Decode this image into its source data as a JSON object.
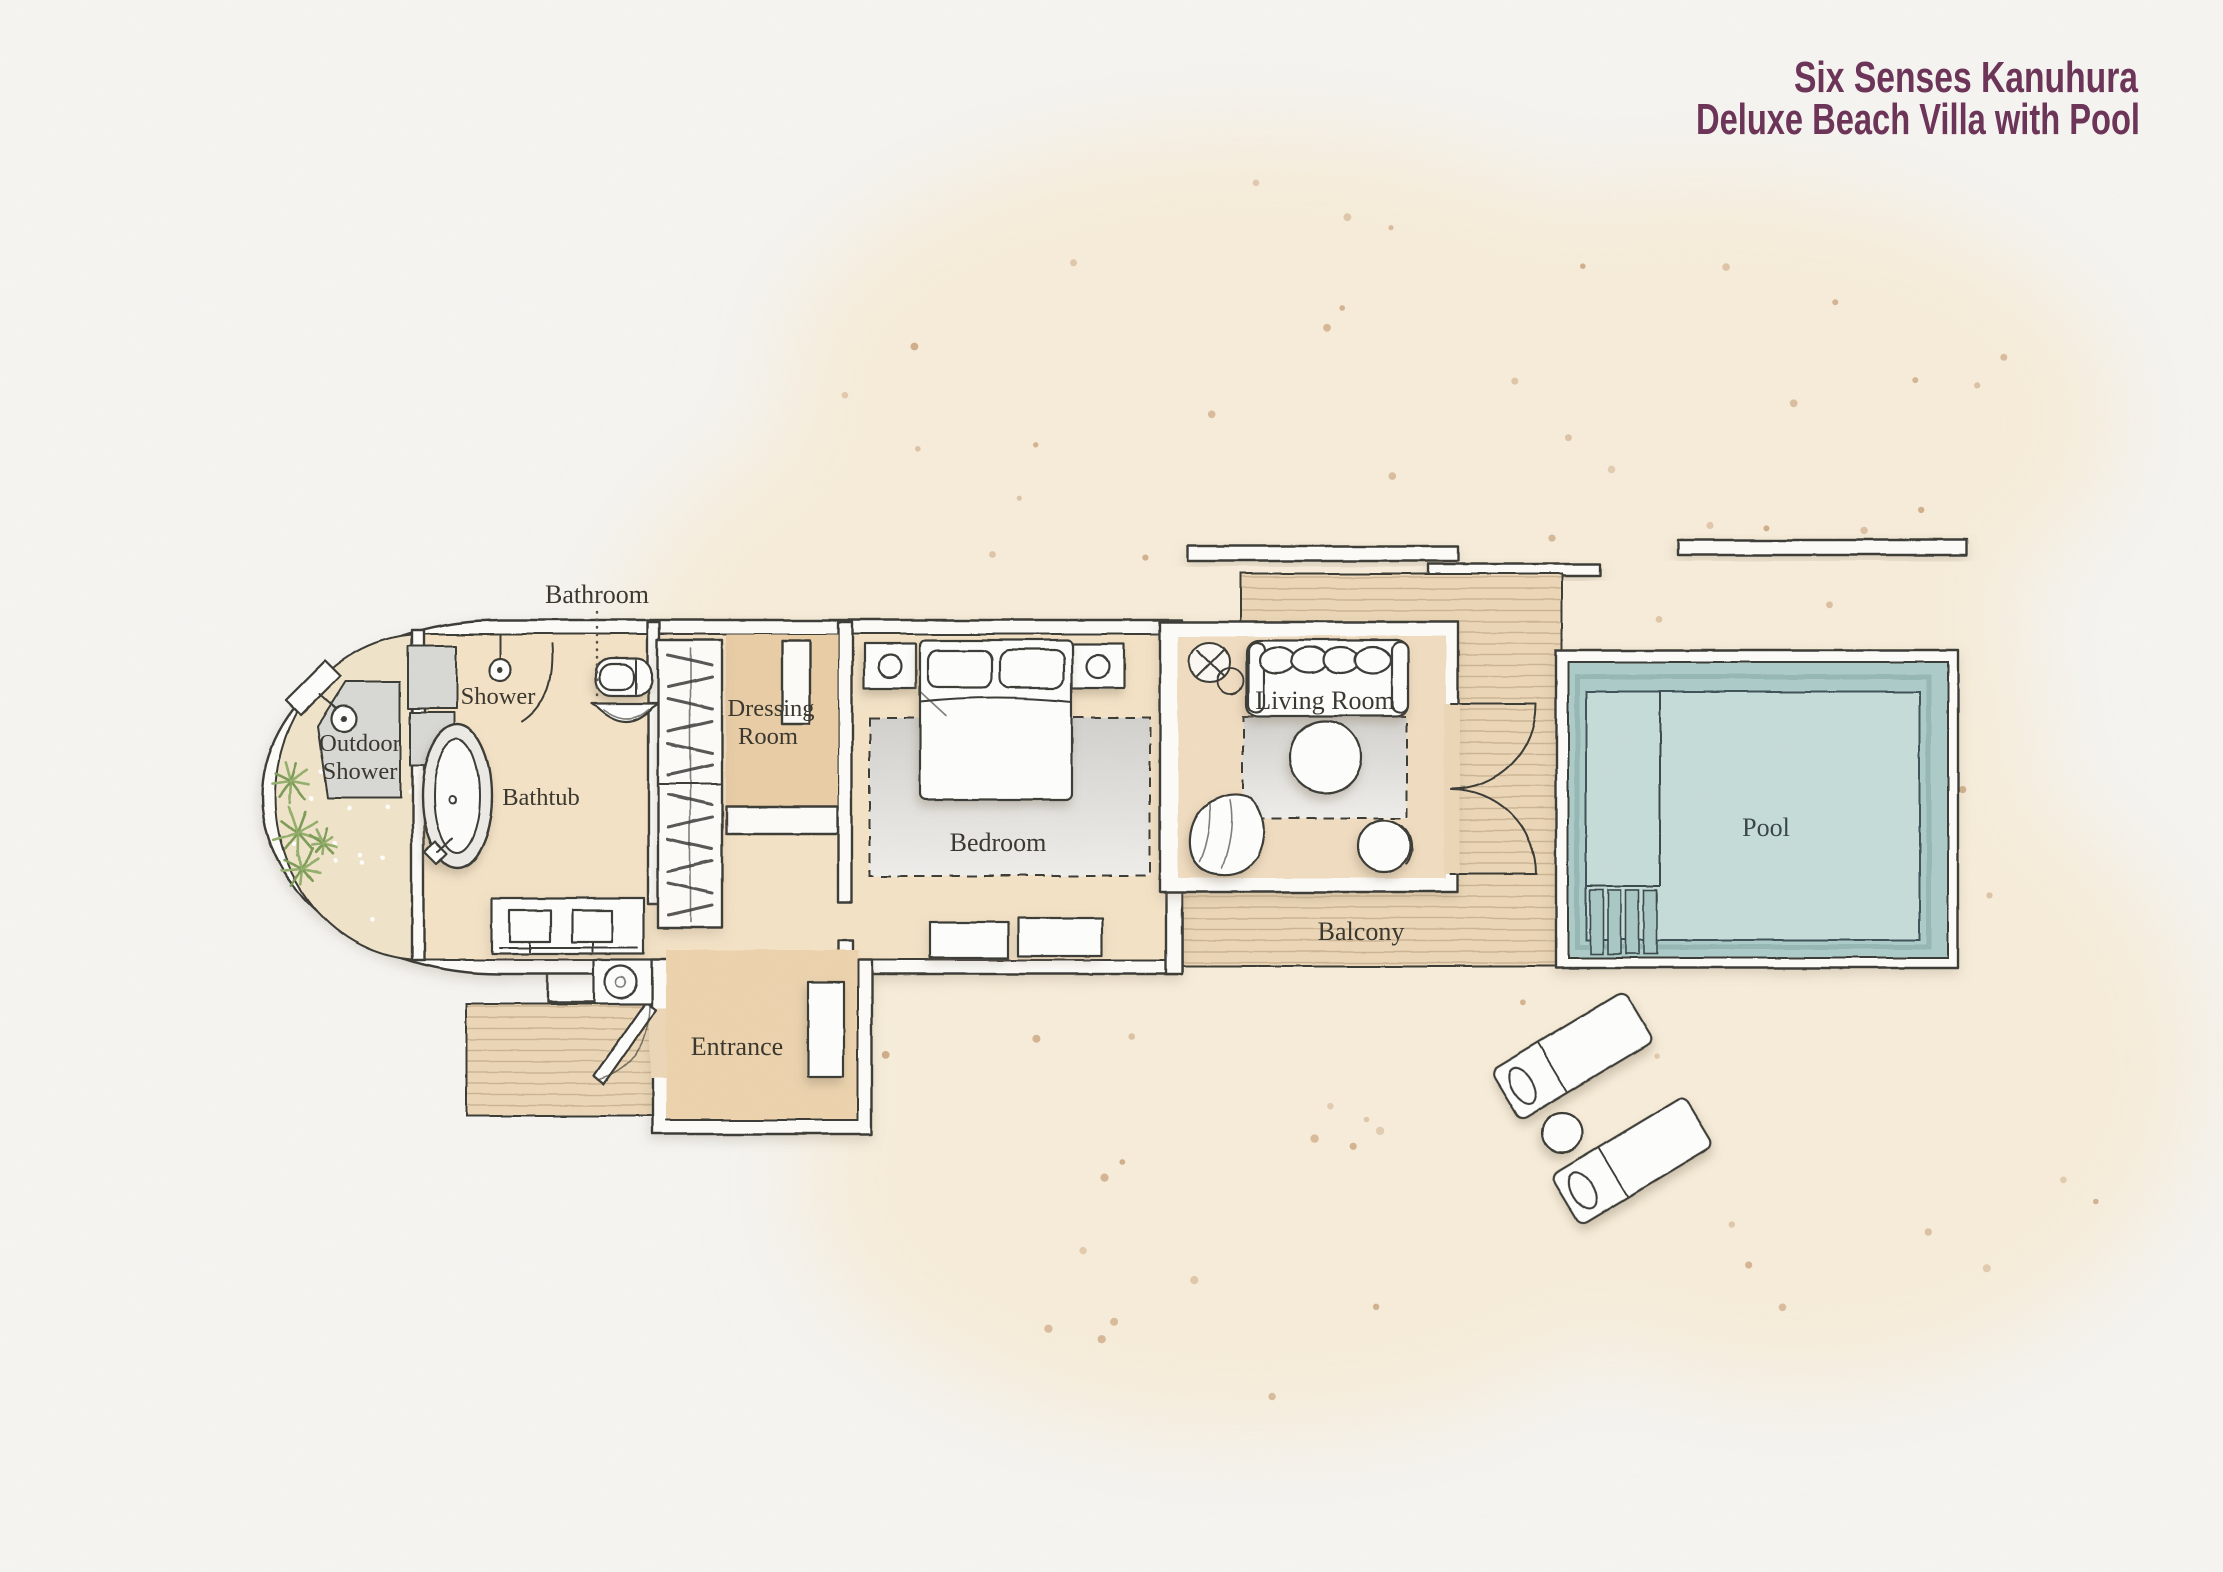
{
  "title": {
    "line1": "Six Senses Kanuhura",
    "line2": "Deluxe Beach Villa with Pool",
    "color": "#6c3458"
  },
  "rooms": {
    "bathroom": "Bathroom",
    "shower": "Shower",
    "outdoor_shower_line1": "Outdoor",
    "outdoor_shower_line2": "Shower",
    "bathtub": "Bathtub",
    "dressing_room_line1": "Dressing",
    "dressing_room_line2": "Room",
    "bedroom": "Bedroom",
    "entrance": "Entrance",
    "living_room": "Living Room",
    "balcony": "Balcony",
    "pool": "Pool"
  },
  "palette": {
    "paper": "#f5f4f1",
    "sand_wash": "#f6ecd9",
    "courtyard_sand": "#efe3ca",
    "floor_tan": "#f3e2c6",
    "floor_dark_tan": "#e8cda6",
    "entrance_floor": "#ecd3ae",
    "living_floor": "#f0dcc0",
    "deck": "#ebd7b7",
    "pool_water": "#adcbc8",
    "pool_inner": "#c6dcd8",
    "wall_outline": "#3e3c38",
    "label_text": "#3a372f",
    "plant_green": "#7e9c59"
  }
}
